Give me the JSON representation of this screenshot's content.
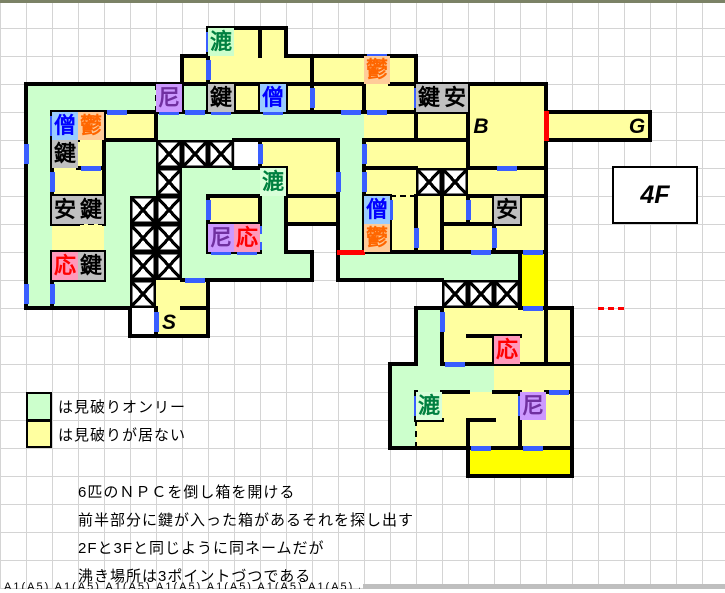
{
  "floor_label": "4F",
  "legend": {
    "items": [
      {
        "color": "#ccffcc",
        "text": "は見破りオンリー"
      },
      {
        "color": "#ffffa0",
        "text": "は見破りが居ない"
      }
    ]
  },
  "notes": [
    "6匹のＮＰＣを倒し箱を開ける",
    "前半部分に鍵が入った箱があるそれを探し出す",
    "2Fと3Fと同じように同ネームだが",
    "沸き場所は3ポイントづつである"
  ],
  "clipped_row_text": "A1(A5) A1(A5) A1(A5) A1(A5) A1(A5) A1(A5) A1(A5) A1(A5)",
  "map": {
    "cols": 27,
    "rows": 17,
    "cw": 26,
    "rh": 28,
    "fills": {
      "g": "#ccffcc",
      "y": "#ffffa0",
      "Y": "#ffff00",
      "w": "#ffffff"
    },
    "wall_color": "#000000",
    "door_color": "#3a5fff",
    "red_color": "#ff0000",
    "grid": [
      "...........................",
      "........gyy................",
      ".......yyyyyyyyy...........",
      ".gggggygyyyyyyyyyyyyy......",
      ".gyyyyggggggggyyyyyyyyyyy..",
      ".gyyggxxx.yyygyyyyyyy......",
      ".gyyggxggggyygyyxxyyy......",
      ".gyygxxgyygyygyyyyyyy......",
      ".gyygxxgyyg..gyyyyyyy......",
      ".gyygxxggggg.gggggggY......",
      ".ggggxyy.........xxxY......",
      ".....wyy........gyyyyy.....",
      "................gyyyyy.....",
      "...............ggggyyy.....",
      "...............ggyyyyy.....",
      "...............gyyyyyy.....",
      "..................YYYY....."
    ],
    "labels": [
      [
        1,
        8,
        "漉",
        "#008040",
        "#ccffcc",
        0
      ],
      [
        2,
        14,
        "鬱",
        "#ff6600",
        "#ffcc99",
        0
      ],
      [
        3,
        6,
        "尼",
        "#7030a0",
        "#cc99ff",
        0
      ],
      [
        3,
        8,
        "鍵",
        "#000000",
        "#c0c0c0",
        0
      ],
      [
        3,
        10,
        "僧",
        "#0000ff",
        "#99ccff",
        0
      ],
      [
        3,
        16,
        "鍵",
        "#000000",
        "#c0c0c0",
        0
      ],
      [
        3,
        17,
        "安",
        "#000000",
        "#c0c0c0",
        0
      ],
      [
        4,
        2,
        "僧",
        "#0000ff",
        "#99ccff",
        0
      ],
      [
        4,
        3,
        "鬱",
        "#ff6600",
        "#ffcc99",
        0
      ],
      [
        4,
        18,
        "B",
        "#000000",
        "",
        1
      ],
      [
        4,
        24,
        "G",
        "#000000",
        "",
        1
      ],
      [
        5,
        2,
        "鍵",
        "#000000",
        "#c0c0c0",
        0
      ],
      [
        6,
        10,
        "漉",
        "#008040",
        "#d9ffd9",
        0
      ],
      [
        7,
        2,
        "安",
        "#000000",
        "#c0c0c0",
        0
      ],
      [
        7,
        3,
        "鍵",
        "#000000",
        "#c0c0c0",
        0
      ],
      [
        7,
        14,
        "僧",
        "#0000ff",
        "#99ccff",
        0
      ],
      [
        7,
        19,
        "安",
        "#000000",
        "#c0c0c0",
        0
      ],
      [
        8,
        8,
        "尼",
        "#7030a0",
        "#cc99ff",
        0
      ],
      [
        8,
        9,
        "応",
        "#ff0000",
        "#ff99bb",
        0
      ],
      [
        8,
        14,
        "鬱",
        "#ff6600",
        "#ffcc99",
        0
      ],
      [
        9,
        2,
        "応",
        "#ff0000",
        "#ff99bb",
        0
      ],
      [
        9,
        3,
        "鍵",
        "#000000",
        "#c0c0c0",
        0
      ],
      [
        11,
        6,
        "S",
        "#000000",
        "",
        1
      ],
      [
        12,
        19,
        "応",
        "#ff0000",
        "#ff99bb",
        0
      ],
      [
        14,
        16,
        "漉",
        "#008040",
        "#d9ffd9",
        0
      ],
      [
        14,
        20,
        "尼",
        "#7030a0",
        "#cc99ff",
        0
      ]
    ],
    "walls_h": [
      [
        3,
        7
      ],
      [
        3,
        8
      ],
      [
        3,
        9
      ],
      [
        3,
        10
      ],
      [
        3,
        11
      ],
      [
        3,
        12
      ],
      [
        3,
        13
      ],
      [
        3,
        15
      ],
      [
        4,
        2
      ],
      [
        4,
        3
      ],
      [
        4,
        4
      ],
      [
        4,
        5
      ],
      [
        4,
        6
      ],
      [
        4,
        7
      ],
      [
        4,
        8
      ],
      [
        4,
        9
      ],
      [
        4,
        10
      ],
      [
        4,
        11
      ],
      [
        4,
        12
      ],
      [
        4,
        13
      ],
      [
        4,
        14
      ],
      [
        4,
        15
      ],
      [
        4,
        16
      ],
      [
        4,
        17
      ],
      [
        5,
        2
      ],
      [
        5,
        4
      ],
      [
        5,
        5
      ],
      [
        5,
        10
      ],
      [
        5,
        11
      ],
      [
        5,
        12
      ],
      [
        5,
        14
      ],
      [
        5,
        15
      ],
      [
        5,
        16
      ],
      [
        5,
        17
      ],
      [
        6,
        3
      ],
      [
        6,
        10
      ],
      [
        6,
        14
      ],
      [
        6,
        15
      ],
      [
        6,
        18
      ],
      [
        6,
        19
      ],
      [
        6,
        20
      ],
      [
        7,
        2
      ],
      [
        7,
        3
      ],
      [
        7,
        8
      ],
      [
        7,
        9
      ],
      [
        7,
        11
      ],
      [
        7,
        12
      ],
      [
        7,
        14
      ],
      [
        7,
        18
      ],
      [
        7,
        19
      ],
      [
        7,
        20
      ],
      [
        8,
        2
      ],
      [
        8,
        8
      ],
      [
        8,
        9
      ],
      [
        8,
        17
      ],
      [
        8,
        18
      ],
      [
        8,
        19
      ],
      [
        9,
        2
      ],
      [
        9,
        3
      ],
      [
        9,
        8
      ],
      [
        9,
        9
      ],
      [
        9,
        14
      ],
      [
        9,
        15
      ],
      [
        9,
        16
      ],
      [
        9,
        17
      ],
      [
        9,
        18
      ],
      [
        9,
        19
      ],
      [
        9,
        20
      ],
      [
        10,
        2
      ],
      [
        10,
        3
      ],
      [
        10,
        7
      ],
      [
        11,
        7
      ],
      [
        11,
        20
      ],
      [
        12,
        18
      ],
      [
        12,
        19
      ],
      [
        13,
        17
      ],
      [
        13,
        18
      ],
      [
        13,
        19
      ],
      [
        13,
        20
      ],
      [
        13,
        21
      ],
      [
        14,
        17
      ],
      [
        14,
        19
      ],
      [
        14,
        21
      ],
      [
        15,
        16
      ],
      [
        15,
        18
      ],
      [
        16,
        18
      ],
      [
        16,
        19
      ],
      [
        16,
        20
      ],
      [
        16,
        21
      ]
    ],
    "walls_v": [
      [
        1,
        10
      ],
      [
        2,
        8
      ],
      [
        2,
        12
      ],
      [
        3,
        7
      ],
      [
        3,
        8
      ],
      [
        3,
        9
      ],
      [
        3,
        10
      ],
      [
        3,
        11
      ],
      [
        3,
        12
      ],
      [
        3,
        14
      ],
      [
        3,
        16
      ],
      [
        3,
        18
      ],
      [
        4,
        2
      ],
      [
        4,
        4
      ],
      [
        4,
        6
      ],
      [
        4,
        16
      ],
      [
        4,
        18
      ],
      [
        5,
        2
      ],
      [
        5,
        4
      ],
      [
        5,
        10
      ],
      [
        5,
        13
      ],
      [
        5,
        14
      ],
      [
        5,
        18
      ],
      [
        6,
        2
      ],
      [
        6,
        4
      ],
      [
        6,
        11
      ],
      [
        6,
        13
      ],
      [
        6,
        14
      ],
      [
        7,
        2
      ],
      [
        7,
        4
      ],
      [
        7,
        8
      ],
      [
        7,
        10
      ],
      [
        7,
        11
      ],
      [
        7,
        13
      ],
      [
        7,
        14
      ],
      [
        7,
        15
      ],
      [
        7,
        16
      ],
      [
        7,
        17
      ],
      [
        7,
        18
      ],
      [
        7,
        19
      ],
      [
        7,
        20
      ],
      [
        8,
        8
      ],
      [
        8,
        14
      ],
      [
        8,
        15
      ],
      [
        8,
        16
      ],
      [
        8,
        17
      ],
      [
        8,
        19
      ],
      [
        9,
        2
      ],
      [
        9,
        4
      ],
      [
        9,
        20
      ],
      [
        10,
        2
      ],
      [
        10,
        20
      ],
      [
        11,
        6
      ],
      [
        11,
        17
      ],
      [
        11,
        21
      ],
      [
        12,
        17
      ],
      [
        12,
        19
      ],
      [
        12,
        21
      ],
      [
        14,
        16
      ],
      [
        14,
        20
      ],
      [
        15,
        18
      ],
      [
        15,
        20
      ]
    ],
    "doors_h": [
      [
        2,
        14
      ],
      [
        4,
        4
      ],
      [
        4,
        6
      ],
      [
        4,
        7
      ],
      [
        4,
        8
      ],
      [
        4,
        10
      ],
      [
        4,
        13
      ],
      [
        4,
        14
      ],
      [
        6,
        3
      ],
      [
        6,
        19
      ],
      [
        9,
        8
      ],
      [
        9,
        9
      ],
      [
        9,
        18
      ],
      [
        9,
        20
      ],
      [
        10,
        7
      ],
      [
        11,
        20
      ],
      [
        13,
        17
      ],
      [
        14,
        21
      ],
      [
        16,
        18
      ],
      [
        16,
        20
      ]
    ],
    "doors_v": [
      [
        1,
        8
      ],
      [
        2,
        8
      ],
      [
        3,
        12
      ],
      [
        3,
        16
      ],
      [
        4,
        2
      ],
      [
        5,
        1
      ],
      [
        5,
        10
      ],
      [
        5,
        14
      ],
      [
        6,
        2
      ],
      [
        6,
        13
      ],
      [
        6,
        14
      ],
      [
        7,
        8
      ],
      [
        7,
        15
      ],
      [
        7,
        18
      ],
      [
        8,
        16
      ],
      [
        8,
        19
      ],
      [
        10,
        1
      ],
      [
        10,
        2
      ],
      [
        11,
        6
      ],
      [
        11,
        17
      ],
      [
        14,
        16
      ],
      [
        14,
        20
      ]
    ],
    "dash_h": [
      [
        8,
        3
      ],
      [
        7,
        15
      ]
    ],
    "dash_v": [
      [
        15,
        16
      ],
      [
        3,
        6
      ]
    ],
    "bluedash_v": [
      [
        8,
        10
      ]
    ],
    "red_v": [
      [
        4,
        21
      ]
    ],
    "red_h": [
      [
        9,
        13
      ]
    ],
    "reddash_h": [
      [
        11,
        23
      ]
    ]
  }
}
